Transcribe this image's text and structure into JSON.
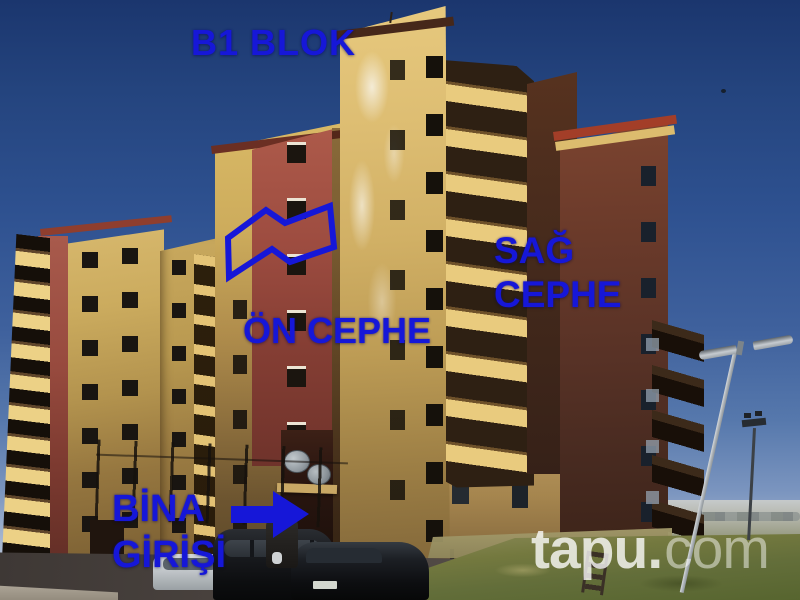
{
  "annotations": {
    "text_color": "#1617d8",
    "block_label": "B1 BLOK",
    "front_facade_label": "ÖN CEPHE",
    "right_facade_label": {
      "line1": "SAĞ",
      "line2": "CEPHE"
    },
    "entrance_label": {
      "line1": "BİNA",
      "line2": "GİRİŞİ"
    },
    "entrance_arrow_icon": "right-arrow",
    "facade_outline_icon": "facade-zigzag-outline"
  },
  "watermark": {
    "brand_bold": "tapu.",
    "brand_light": "com",
    "color": "#ffffff"
  }
}
